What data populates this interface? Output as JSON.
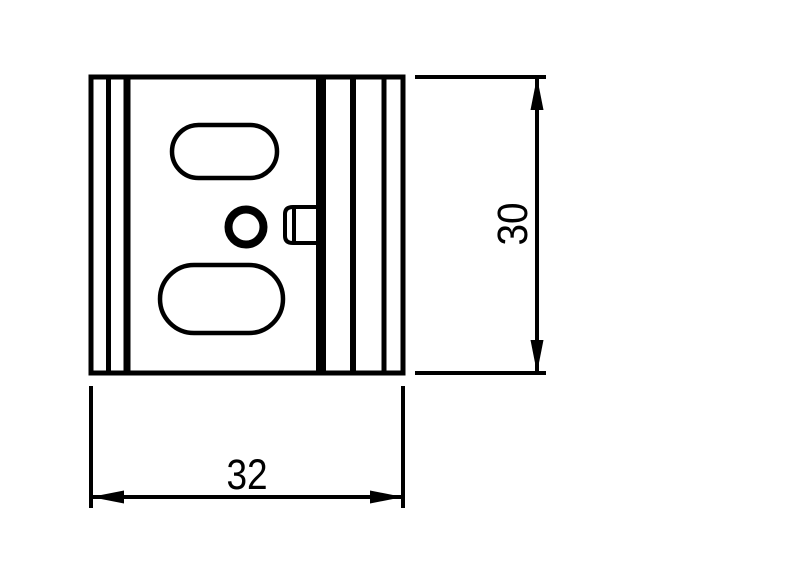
{
  "drawing": {
    "kind": "technical-drawing",
    "view_name": "front view",
    "background_color": "#ffffff",
    "line_color": "#000000",
    "part": {
      "name": "mounting-plate",
      "features": [
        "outer rectangular outline",
        "two vertical groove lines on left edge",
        "thick vertical band and two groove lines on right edge",
        "upper obround slot",
        "lower obround slot",
        "central round hole",
        "latch tab on right of center hole"
      ]
    },
    "dimensions": {
      "width": {
        "value": "32",
        "orientation": "horizontal",
        "position": "bottom",
        "arrows": "outward-filled"
      },
      "height": {
        "value": "30",
        "orientation": "vertical",
        "position": "right",
        "arrows": "outward-filled"
      }
    }
  }
}
